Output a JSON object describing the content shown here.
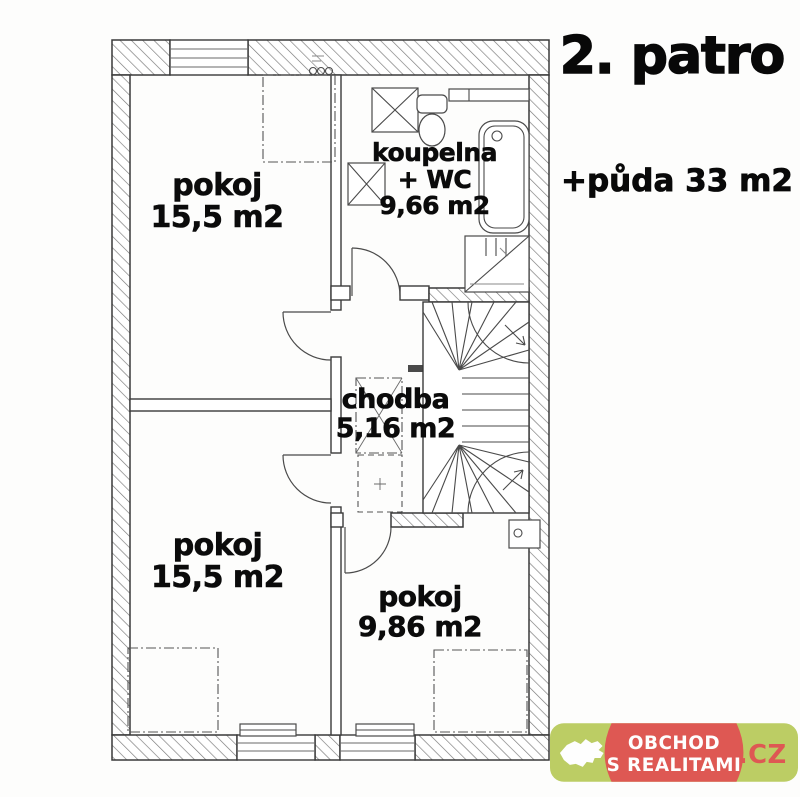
{
  "title": "2. patro",
  "attic_note": "+půda 33 m2",
  "rooms": {
    "top_left": {
      "name": "pokoj",
      "area": "15,5 m2"
    },
    "bathroom": {
      "name": "koupelna",
      "name_suffix": "+ WC",
      "area": "9,66 m2"
    },
    "hallway": {
      "name": "chodba",
      "area": "5,16 m2"
    },
    "bottom_left": {
      "name": "pokoj",
      "area": "15,5 m2"
    },
    "bottom_middle": {
      "name": "pokoj",
      "area": "9,86 m2"
    }
  },
  "watermark": {
    "line1": "OBCHOD",
    "line2": "S REALITAMI",
    "tld": ".CZ",
    "green": "#b7ca58",
    "red": "#dc4b45",
    "text_color": "#ffffff"
  },
  "plan": {
    "line_color": "#3a3a3a",
    "label_color": "#0b0b0b",
    "background": "#fdfdfc"
  }
}
